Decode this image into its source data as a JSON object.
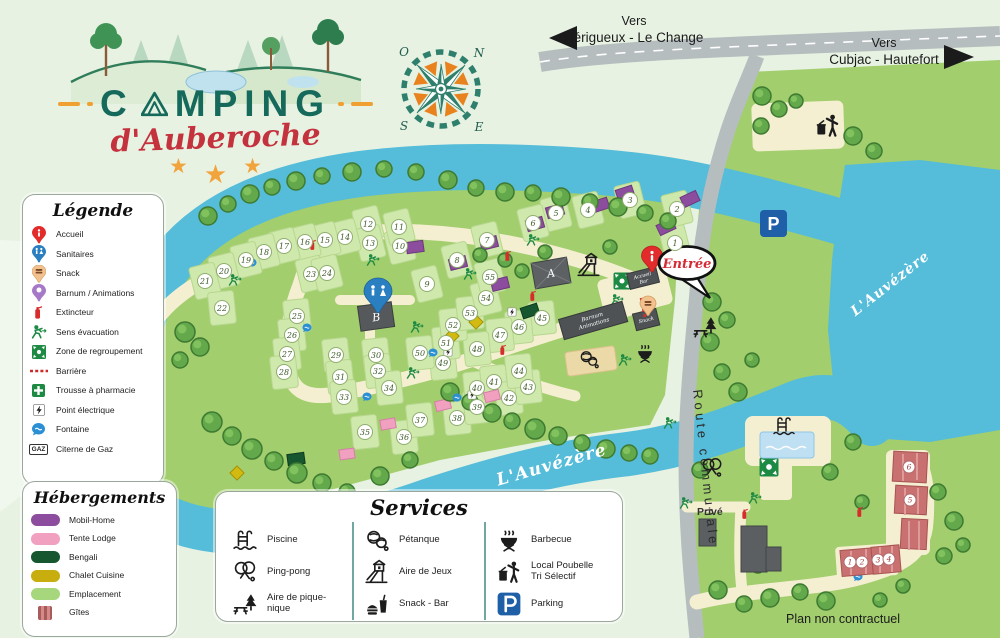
{
  "logo": {
    "title_c": "C",
    "title_rest": "MPING",
    "subtitle": "d'Auberoche",
    "star": "★"
  },
  "directions": {
    "left_line1": "Vers",
    "left_line2": "Périgueux - Le Change",
    "right_line1": "Vers",
    "right_line2": "Cubjac - Hautefort"
  },
  "compass": {
    "o": "O",
    "n": "N",
    "s": "S",
    "e": "E"
  },
  "legend": {
    "title": "Légende",
    "gaz_icon_text": "GAZ",
    "items": [
      {
        "icon": "accueil-pin",
        "label": "Accueil"
      },
      {
        "icon": "sanitaires-pin",
        "label": "Sanitaires"
      },
      {
        "icon": "snack-pin",
        "label": "Snack"
      },
      {
        "icon": "barnum-pin",
        "label": "Barnum / Animations"
      },
      {
        "icon": "extincteur",
        "label": "Extincteur"
      },
      {
        "icon": "evacuation",
        "label": "Sens évacuation"
      },
      {
        "icon": "regroupement",
        "label": "Zone de regroupement"
      },
      {
        "icon": "barriere",
        "label": "Barrière"
      },
      {
        "icon": "pharmacie",
        "label": "Trousse à pharmacie"
      },
      {
        "icon": "point-electrique",
        "label": "Point électrique"
      },
      {
        "icon": "fontaine",
        "label": "Fontaine"
      },
      {
        "icon": "gaz",
        "label": "Citerne de Gaz"
      }
    ]
  },
  "hebergements": {
    "title": "Hébergements",
    "items": [
      {
        "label": "Mobil-Home",
        "color": "#8d4d9e"
      },
      {
        "label": "Tente Lodge",
        "color": "#f2a0bf"
      },
      {
        "label": "Bengali",
        "color": "#17572f"
      },
      {
        "label": "Chalet Cuisine",
        "color": "#c8ad0e"
      },
      {
        "label": "Emplacement",
        "color": "#a6d77c"
      },
      {
        "label": "Gîtes",
        "color": "#cd6f6f"
      }
    ]
  },
  "services": {
    "title": "Services",
    "items": [
      {
        "label": "Piscine",
        "label2": ""
      },
      {
        "label": "Ping-pong",
        "label2": ""
      },
      {
        "label": "Aire de pique-nique",
        "label2": ""
      },
      {
        "label": "Pétanque",
        "label2": ""
      },
      {
        "label": "Aire de Jeux",
        "label2": ""
      },
      {
        "label": "Snack - Bar",
        "label2": ""
      },
      {
        "label": "Barbecue",
        "label2": ""
      },
      {
        "label": "Local Poubelle",
        "label2": "Tri Sélectif"
      },
      {
        "label": "Parking",
        "label2": ""
      }
    ]
  },
  "map": {
    "entrance": "Entrée",
    "river_label": "L'Auvézère",
    "route_label": "Route communale",
    "prive": "Privé",
    "parking": "P",
    "building_a": "A",
    "building_b": "B",
    "accueil_building_line1": "Accueil",
    "accueil_building_line2": "Bar",
    "snack_building": "Snack",
    "barnum_line1": "Barnum",
    "barnum_line2": "Animations",
    "disclaimer": "Plan non contractuel",
    "plots": [
      {
        "n": 1,
        "x": 675,
        "y": 243
      },
      {
        "n": 2,
        "x": 677,
        "y": 209
      },
      {
        "n": 3,
        "x": 630,
        "y": 200
      },
      {
        "n": 4,
        "x": 588,
        "y": 210
      },
      {
        "n": 5,
        "x": 556,
        "y": 213
      },
      {
        "n": 6,
        "x": 533,
        "y": 223
      },
      {
        "n": 7,
        "x": 487,
        "y": 240
      },
      {
        "n": 8,
        "x": 457,
        "y": 260
      },
      {
        "n": 9,
        "x": 427,
        "y": 284
      },
      {
        "n": 10,
        "x": 400,
        "y": 246
      },
      {
        "n": 11,
        "x": 399,
        "y": 227
      },
      {
        "n": 12,
        "x": 368,
        "y": 224
      },
      {
        "n": 13,
        "x": 370,
        "y": 243
      },
      {
        "n": 14,
        "x": 345,
        "y": 237
      },
      {
        "n": 15,
        "x": 325,
        "y": 240
      },
      {
        "n": 16,
        "x": 305,
        "y": 242
      },
      {
        "n": 17,
        "x": 284,
        "y": 246
      },
      {
        "n": 18,
        "x": 264,
        "y": 252
      },
      {
        "n": 19,
        "x": 246,
        "y": 260
      },
      {
        "n": 20,
        "x": 224,
        "y": 271
      },
      {
        "n": 21,
        "x": 205,
        "y": 281
      },
      {
        "n": 22,
        "x": 222,
        "y": 308
      },
      {
        "n": 23,
        "x": 311,
        "y": 274
      },
      {
        "n": 24,
        "x": 327,
        "y": 273
      },
      {
        "n": 25,
        "x": 297,
        "y": 316
      },
      {
        "n": 26,
        "x": 292,
        "y": 335
      },
      {
        "n": 27,
        "x": 287,
        "y": 354
      },
      {
        "n": 28,
        "x": 284,
        "y": 372
      },
      {
        "n": 29,
        "x": 336,
        "y": 355
      },
      {
        "n": 30,
        "x": 376,
        "y": 355
      },
      {
        "n": 31,
        "x": 340,
        "y": 377
      },
      {
        "n": 32,
        "x": 378,
        "y": 371
      },
      {
        "n": 33,
        "x": 344,
        "y": 397
      },
      {
        "n": 34,
        "x": 389,
        "y": 388
      },
      {
        "n": 35,
        "x": 365,
        "y": 432
      },
      {
        "n": 36,
        "x": 404,
        "y": 437
      },
      {
        "n": 37,
        "x": 420,
        "y": 420
      },
      {
        "n": 38,
        "x": 457,
        "y": 418
      },
      {
        "n": 39,
        "x": 477,
        "y": 407
      },
      {
        "n": 40,
        "x": 477,
        "y": 388
      },
      {
        "n": 41,
        "x": 494,
        "y": 382
      },
      {
        "n": 42,
        "x": 509,
        "y": 398
      },
      {
        "n": 43,
        "x": 528,
        "y": 387
      },
      {
        "n": 44,
        "x": 519,
        "y": 371
      },
      {
        "n": 45,
        "x": 542,
        "y": 318
      },
      {
        "n": 46,
        "x": 519,
        "y": 327
      },
      {
        "n": 47,
        "x": 500,
        "y": 335
      },
      {
        "n": 48,
        "x": 477,
        "y": 349
      },
      {
        "n": 49,
        "x": 443,
        "y": 363
      },
      {
        "n": 50,
        "x": 420,
        "y": 353
      },
      {
        "n": 51,
        "x": 446,
        "y": 343
      },
      {
        "n": 52,
        "x": 453,
        "y": 325
      },
      {
        "n": 53,
        "x": 470,
        "y": 313
      },
      {
        "n": 54,
        "x": 486,
        "y": 298
      },
      {
        "n": 55,
        "x": 490,
        "y": 277
      }
    ],
    "gites": [
      {
        "n": 1,
        "x": 850,
        "y": 562
      },
      {
        "n": 2,
        "x": 862,
        "y": 562
      },
      {
        "n": 3,
        "x": 878,
        "y": 560
      },
      {
        "n": 4,
        "x": 889,
        "y": 559
      },
      {
        "n": 5,
        "x": 910,
        "y": 500
      },
      {
        "n": 6,
        "x": 909,
        "y": 467
      }
    ]
  }
}
